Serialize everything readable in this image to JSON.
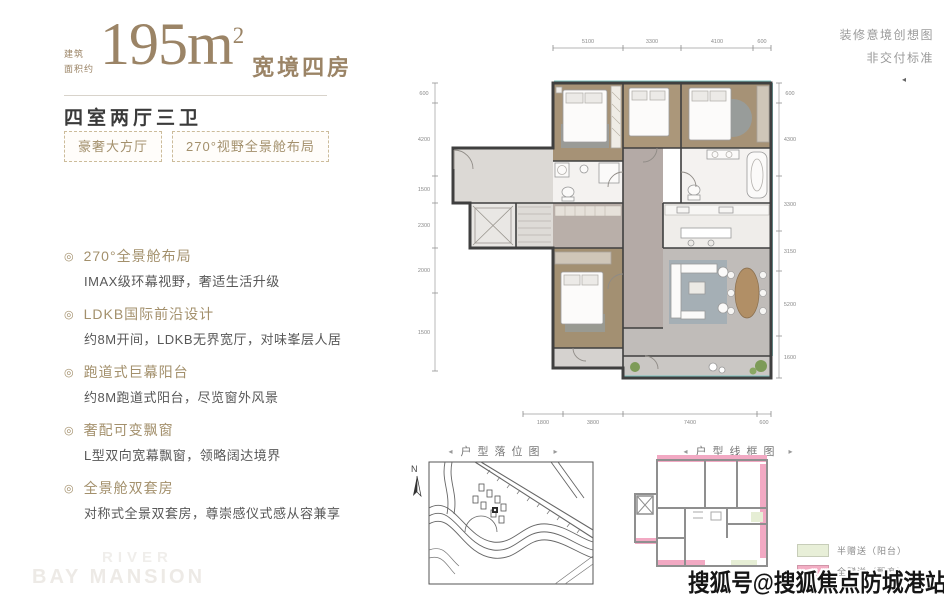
{
  "header": {
    "area_label_line1": "建筑",
    "area_label_line2": "面积约",
    "area_number": "195m",
    "area_exponent": "2",
    "area_name": "宽境四房",
    "layout_line": "四室两厅三卫",
    "badges": [
      {
        "label": "豪奢大方厅"
      },
      {
        "label": "270°视野全景舱布局"
      }
    ]
  },
  "disclaimer": {
    "line1": "装修意境创想图",
    "line2": "非交付标准",
    "mark": "◂"
  },
  "features": {
    "bullet": "◎",
    "items": [
      {
        "title": "270°全景舱布局",
        "desc": "IMAX级环幕视野，奢适生活升级"
      },
      {
        "title": "LDKB国际前沿设计",
        "desc": "约8M开间，LDKB无界宽厅，对味峯层人居"
      },
      {
        "title": "跑道式巨幕阳台",
        "desc": "约8M跑道式阳台，尽览窗外风景"
      },
      {
        "title": "奢配可变飘窗",
        "desc": "L型双向宽幕飘窗，领略阔达境界"
      },
      {
        "title": "全景舱双套房",
        "desc": "对称式全景双套房，尊崇感仪式感从容兼享"
      }
    ]
  },
  "floorplan": {
    "dims_top": [
      "5100",
      "3300",
      "4100",
      "600"
    ],
    "dims_bottom": [
      "1800",
      "3800",
      "7400",
      "600"
    ],
    "dims_left": [
      "600",
      "4200",
      "1500",
      "2300",
      "2000",
      "1500"
    ],
    "dims_right": [
      "600",
      "4300",
      "3300",
      "3150",
      "5200",
      "1600"
    ]
  },
  "locator": {
    "deco_left": "◂",
    "label": "户型落位图",
    "deco_right": "▸",
    "compass_n": "N"
  },
  "wireframe": {
    "deco_left": "◂",
    "label": "户型线框图",
    "deco_right": "▸"
  },
  "legend": {
    "items": [
      {
        "label": "半赠送（阳台）",
        "color": "#e8efd8"
      },
      {
        "label": "全赠送（飘窗）",
        "color": "#f3aec4"
      }
    ]
  },
  "watermarks": {
    "brand_line1": "RIVER",
    "brand_line2": "BAY MANSION",
    "sohu": "搜狐号@搜狐焦点防城港站"
  },
  "colors": {
    "accent": "#9b8466",
    "wall": "#3f3f3f",
    "wood": "#a69276",
    "glass": "#7fc4c2",
    "living_gray": "#c0bcb9"
  }
}
